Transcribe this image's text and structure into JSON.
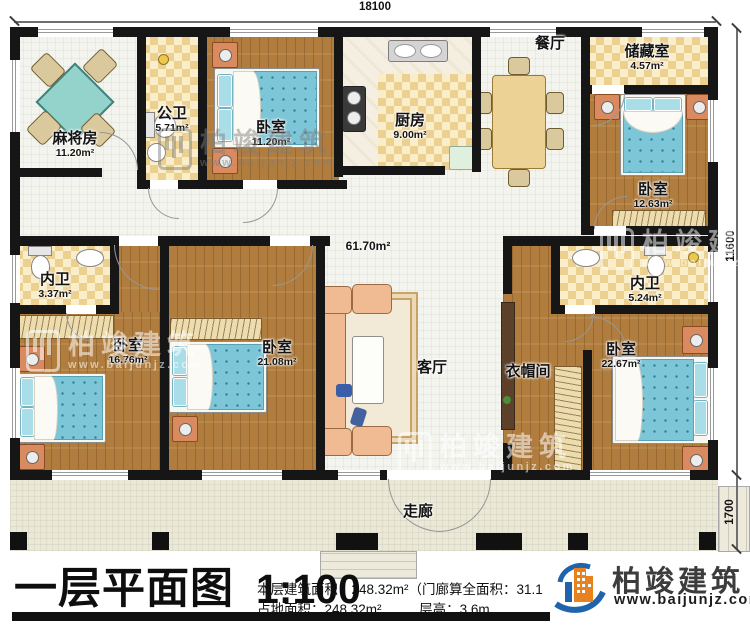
{
  "dimensions": {
    "top": "18100",
    "right_main": "11600",
    "right_porch": "1700"
  },
  "rooms": [
    {
      "label": "麻将房",
      "area": "11.20m²"
    },
    {
      "label": "公卫",
      "area": "5.71m²"
    },
    {
      "label": "卧室",
      "area": "11.20m²"
    },
    {
      "label": "厨房",
      "area": "9.00m²"
    },
    {
      "label": "餐厅",
      "area": ""
    },
    {
      "label": "储藏室",
      "area": "4.57m²"
    },
    {
      "label": "卧室",
      "area": "12.63m²"
    },
    {
      "label": "内卫",
      "area": "3.37m²"
    },
    {
      "label": "卧室",
      "area": "16.76m²"
    },
    {
      "label": "卧室",
      "area": "21.08m²"
    },
    {
      "label": "客厅",
      "area": "61.70m²"
    },
    {
      "label": "内卫",
      "area": "5.24m²"
    },
    {
      "label": "衣帽间",
      "area": ""
    },
    {
      "label": "卧室",
      "area": "22.67m²"
    },
    {
      "label": "走廊",
      "area": ""
    }
  ],
  "footer": {
    "plan_title": "一层平面图",
    "plan_scale": "1:100",
    "stat_line1": "本层建筑面积：248.32m²（门廊算全面积：31.1",
    "stat_line2a": "占地面积：248.32m²",
    "stat_line2b": "层高：3.6m"
  },
  "logo": {
    "name": "柏竣建筑",
    "url": "www.baijunjz.com"
  },
  "watermark": {
    "brand": "柏竣建筑",
    "url": "www.baijunjz.com"
  },
  "colors": {
    "wall": "#161616",
    "wood": "#b07d3e",
    "checker": "#ecd08f",
    "mattress": "#7cc6d8",
    "accent_orange": "#e8821e",
    "accent_blue": "#1f63ad"
  }
}
